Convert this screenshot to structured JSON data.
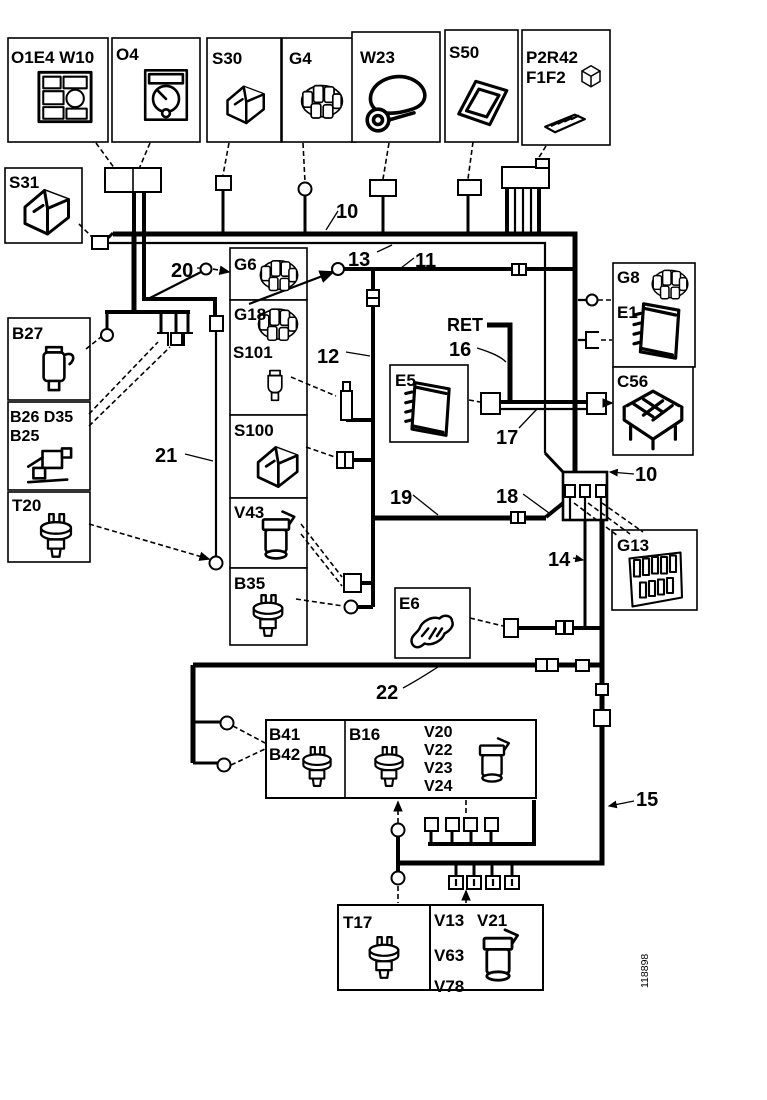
{
  "figure_number": "118898",
  "colors": {
    "ink": "#000000",
    "paper": "#ffffff"
  },
  "components": [
    {
      "label": "O1E4 W10",
      "icon": "instrument-cluster-icon"
    },
    {
      "label": "O4",
      "icon": "gauge-icon"
    },
    {
      "label": "S30",
      "icon": "switch-icon"
    },
    {
      "label": "G4",
      "icon": "round-connector-icon"
    },
    {
      "label": "W23",
      "icon": "horn-icon"
    },
    {
      "label": "S50",
      "icon": "frame-icon"
    },
    {
      "label": "P2R42",
      "label2": "F1F2",
      "icon": "relay-fuse-icon"
    },
    {
      "label": "S31",
      "icon": "switch-icon"
    },
    {
      "label": "B27",
      "icon": "sensor-icon"
    },
    {
      "label": "B26 D35",
      "label2": "B25",
      "icon": "pump-icon"
    },
    {
      "label": "T20",
      "icon": "temp-sensor-icon"
    },
    {
      "label": "G6",
      "icon": "round-connector-icon"
    },
    {
      "label": "G18",
      "icon": "round-connector-icon"
    },
    {
      "label": "S101",
      "icon": "plug-sensor-icon"
    },
    {
      "label": "S100",
      "icon": "switch-icon"
    },
    {
      "label": "V43",
      "icon": "valve-icon"
    },
    {
      "label": "B35",
      "icon": "temp-sensor-icon"
    },
    {
      "label": "E5",
      "icon": "ecu-icon"
    },
    {
      "label": "E6",
      "icon": "engine-icon"
    },
    {
      "label": "G8",
      "label2": "E1",
      "icon": "ecu-icon"
    },
    {
      "label": "C56",
      "icon": "module-icon"
    },
    {
      "label": "G13",
      "icon": "fuse-panel-icon"
    },
    {
      "label": "B41",
      "label2": "B42",
      "icon": "temp-sensor-icon"
    },
    {
      "label": "B16",
      "icon": "temp-sensor-icon"
    },
    {
      "labels": [
        "V20",
        "V22",
        "V23",
        "V24"
      ],
      "icon": "valve-icon"
    },
    {
      "label": "T17",
      "icon": "temp-sensor-icon"
    },
    {
      "label": "V13",
      "label2": "V21",
      "label3": "V63",
      "label4": "V78",
      "icon": "valve-icon"
    }
  ],
  "wire_labels": {
    "bus_top": "10",
    "n11": "11",
    "n12": "12",
    "n13": "13",
    "n14": "14",
    "n15": "15",
    "n16": "16",
    "n17": "17",
    "n18": "18",
    "n19": "19",
    "n20": "20",
    "n21": "21",
    "n22": "22",
    "bus_right": "10",
    "ret": "RET"
  }
}
